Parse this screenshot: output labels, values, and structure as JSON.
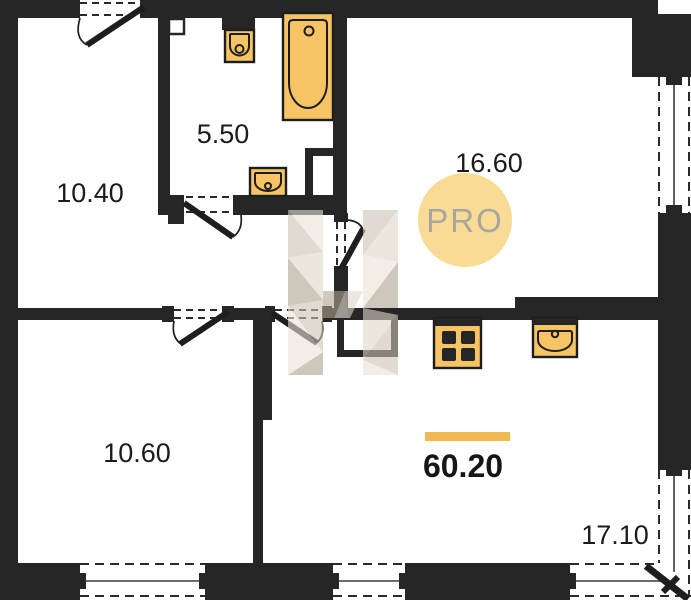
{
  "floorplan": {
    "total_area": "60.20",
    "watermark": {
      "badge_text": "PRO"
    },
    "rooms": [
      {
        "id": "entry-room",
        "area": "10.40"
      },
      {
        "id": "bathroom",
        "area": "5.50"
      },
      {
        "id": "living-room",
        "area": "16.60"
      },
      {
        "id": "bedroom",
        "area": "10.60"
      },
      {
        "id": "kitchen-living",
        "area": "17.10"
      }
    ],
    "fixtures": [
      "bathtub",
      "toilet",
      "wash-basin",
      "kitchen-sink",
      "stove"
    ]
  },
  "colors": {
    "wall": "#262626",
    "fixture_fill": "#f6c464",
    "accent_bar": "#efb94f",
    "pro_circle_fill": "#f8d98e",
    "pro_text": "#a9a5a0",
    "wm_light": "#eae3d8",
    "wm_mid": "#cdc2b2",
    "wm_pale": "#ded6c9",
    "wm_dark": "#afa290"
  }
}
